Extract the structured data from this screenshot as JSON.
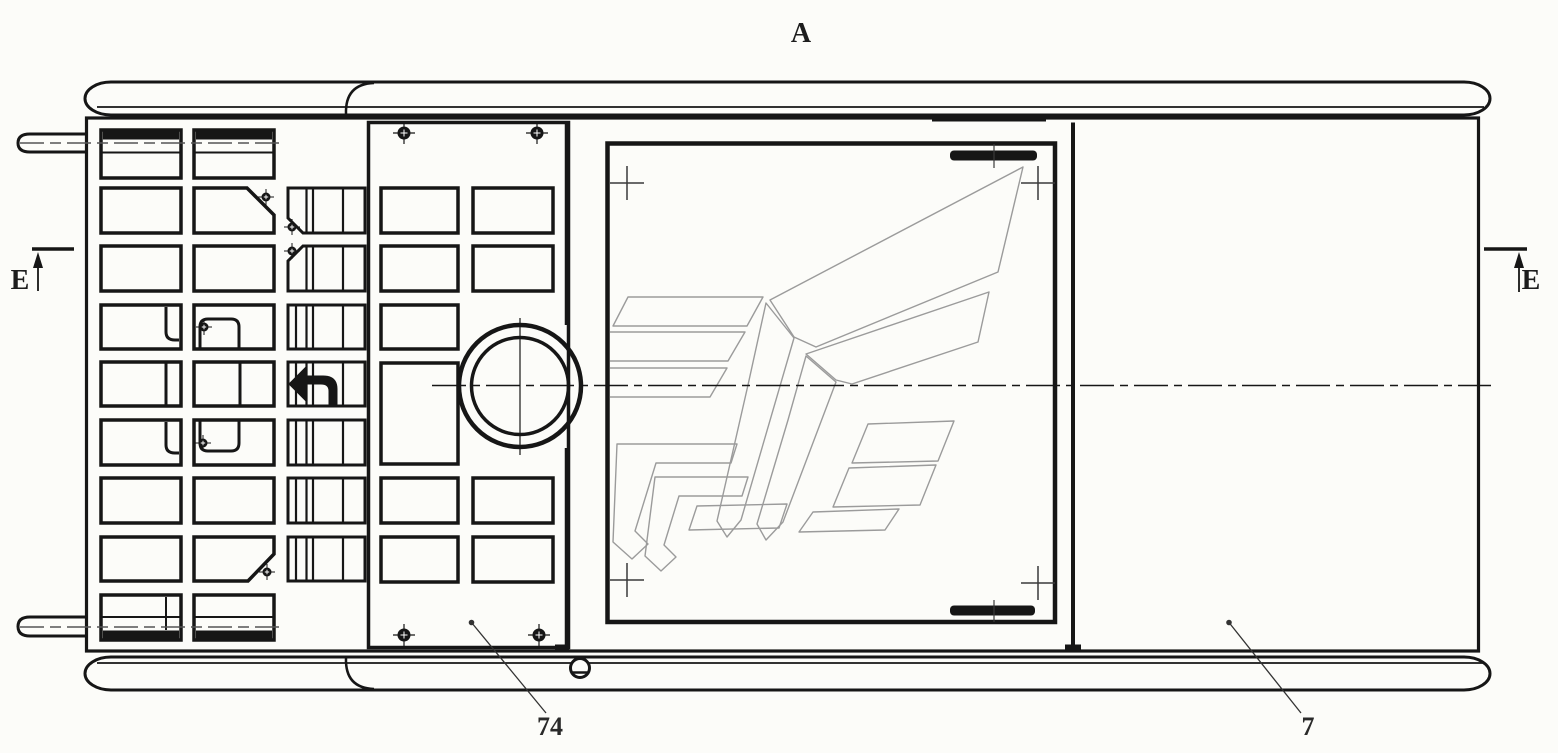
{
  "drawing": {
    "view_label": "A",
    "section_marker_left": "E",
    "section_marker_right": "E",
    "callout_center_panel": "74",
    "callout_right_cover": "7",
    "colors": {
      "line": "#161616",
      "logo_line": "#9b9b9b",
      "background": "#fcfcf9",
      "centerline_gray": "#555555",
      "cross_gray": "#3a3a3a"
    },
    "icons": [
      "screw-head-icon",
      "registration-cross-icon",
      "camera-lens-icon",
      "speaker-slot-icon",
      "wing-emblem-logo",
      "section-arrow-icon",
      "return-arrow-icon",
      "hinge-pin-icon"
    ]
  }
}
